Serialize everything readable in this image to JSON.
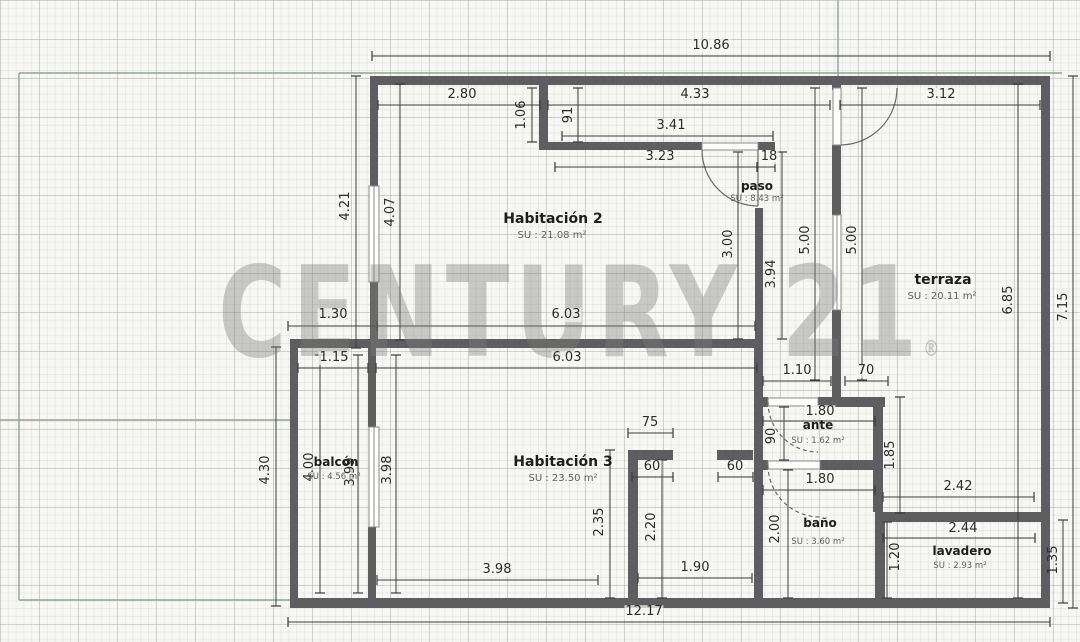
{
  "watermark": {
    "text": "CENTURY 21",
    "registered": "®"
  },
  "rooms": [
    {
      "name": "Habitación 2",
      "area": "SU : 21.08 m²",
      "nx": 553,
      "ny": 219,
      "ax": 552,
      "ay": 236,
      "fs": 14,
      "afs": 10
    },
    {
      "name": "paso",
      "area": "SU : 8.43 m²",
      "nx": 757,
      "ny": 186,
      "ax": 757,
      "ay": 199,
      "fs": 12,
      "afs": 8.5
    },
    {
      "name": "terraza",
      "area": "SU : 20.11 m²",
      "nx": 943,
      "ny": 280,
      "ax": 942,
      "ay": 297,
      "fs": 14,
      "afs": 10
    },
    {
      "name": "Habitación 3",
      "area": "SU : 23.50 m²",
      "nx": 563,
      "ny": 462,
      "ax": 563,
      "ay": 479,
      "fs": 14,
      "afs": 10
    },
    {
      "name": "balcón",
      "area": "SU : 4.56 m²",
      "nx": 336,
      "ny": 462,
      "ax": 334,
      "ay": 477,
      "fs": 12,
      "afs": 8.5
    },
    {
      "name": "ante",
      "area": "SU : 1.62 m²",
      "nx": 818,
      "ny": 425,
      "ax": 818,
      "ay": 441,
      "fs": 12,
      "afs": 8.5
    },
    {
      "name": "baño",
      "area": "SU : 3.60 m²",
      "nx": 820,
      "ny": 523,
      "ax": 818,
      "ay": 542,
      "fs": 12,
      "afs": 8.5
    },
    {
      "name": "lavadero",
      "area": "SU : 2.93 m²",
      "nx": 962,
      "ny": 551,
      "ax": 960,
      "ay": 566,
      "fs": 12,
      "afs": 8.5
    }
  ],
  "dims": [
    {
      "t": "10.86",
      "x": 711,
      "y": 46,
      "rot": 0,
      "line": [
        372,
        56,
        1050,
        56
      ]
    },
    {
      "t": "2.80",
      "x": 462,
      "y": 95,
      "rot": 0,
      "line": [
        378,
        105,
        540,
        105
      ]
    },
    {
      "t": "4.33",
      "x": 695,
      "y": 95,
      "rot": 0,
      "line": [
        548,
        105,
        830,
        105
      ]
    },
    {
      "t": "3.12",
      "x": 941,
      "y": 95,
      "rot": 0,
      "line": [
        840,
        105,
        1040,
        105
      ]
    },
    {
      "t": "3.41",
      "x": 671,
      "y": 126,
      "rot": 0,
      "line": [
        562,
        136,
        773,
        136
      ]
    },
    {
      "t": "3.23",
      "x": 660,
      "y": 157,
      "rot": 0,
      "line": [
        555,
        167,
        757,
        167
      ]
    },
    {
      "t": "18",
      "x": 769,
      "y": 157,
      "rot": 0,
      "line": [
        757,
        167,
        775,
        167
      ]
    },
    {
      "t": "1.30",
      "x": 333,
      "y": 315,
      "rot": 0,
      "line": [
        288,
        326,
        377,
        326
      ]
    },
    {
      "t": "6.03",
      "x": 566,
      "y": 315,
      "rot": 0,
      "line": [
        377,
        326,
        755,
        326
      ]
    },
    {
      "t": "1.15",
      "x": 334,
      "y": 358,
      "rot": 0,
      "line": [
        298,
        368,
        368,
        368
      ]
    },
    {
      "t": "6.03",
      "x": 567,
      "y": 358,
      "rot": 0,
      "line": [
        376,
        368,
        757,
        368
      ]
    },
    {
      "t": "1.10",
      "x": 797,
      "y": 371,
      "rot": 0,
      "line": [
        763,
        381,
        831,
        381
      ]
    },
    {
      "t": "70",
      "x": 866,
      "y": 371,
      "rot": 0,
      "line": [
        845,
        381,
        888,
        381
      ]
    },
    {
      "t": "1.80",
      "x": 820,
      "y": 412,
      "rot": 0,
      "line": [
        763,
        421,
        875,
        421
      ]
    },
    {
      "t": "1.80",
      "x": 820,
      "y": 480,
      "rot": 0,
      "line": [
        763,
        490,
        875,
        490
      ]
    },
    {
      "t": "2.42",
      "x": 958,
      "y": 487,
      "rot": 0,
      "line": [
        883,
        497,
        1034,
        497
      ]
    },
    {
      "t": "2.44",
      "x": 963,
      "y": 529,
      "rot": 0,
      "line": [
        883,
        538,
        1035,
        538
      ]
    },
    {
      "t": "75",
      "x": 650,
      "y": 423,
      "rot": 0,
      "line": [
        628,
        433,
        673,
        433
      ]
    },
    {
      "t": "60",
      "x": 652,
      "y": 467,
      "rot": 0,
      "line": [
        632,
        477,
        673,
        477
      ]
    },
    {
      "t": "60",
      "x": 735,
      "y": 467,
      "rot": 0,
      "line": [
        718,
        477,
        753,
        477
      ]
    },
    {
      "t": "1.90",
      "x": 695,
      "y": 568,
      "rot": 0,
      "line": [
        638,
        578,
        752,
        578
      ]
    },
    {
      "t": "3.98",
      "x": 497,
      "y": 570,
      "rot": 0,
      "line": [
        377,
        580,
        598,
        580
      ]
    },
    {
      "t": "12.17",
      "x": 644,
      "y": 612,
      "rot": 0,
      "line": [
        288,
        622,
        1050,
        622
      ]
    },
    {
      "t": "4.21",
      "x": 346,
      "y": 206,
      "rot": 1,
      "line": [
        356,
        76,
        356,
        348
      ]
    },
    {
      "t": "4.07",
      "x": 391,
      "y": 212,
      "rot": 1,
      "line": [
        400,
        84,
        400,
        340
      ]
    },
    {
      "t": "1.06",
      "x": 522,
      "y": 115,
      "rot": 1,
      "line": [
        532,
        88,
        532,
        142
      ]
    },
    {
      "t": "91",
      "x": 569,
      "y": 115,
      "rot": 1,
      "line": [
        578,
        88,
        578,
        142
      ]
    },
    {
      "t": "3.00",
      "x": 729,
      "y": 244,
      "rot": 1,
      "line": [
        738,
        152,
        738,
        339
      ]
    },
    {
      "t": "3.94",
      "x": 772,
      "y": 274,
      "rot": 1,
      "line": [
        782,
        152,
        782,
        339
      ]
    },
    {
      "t": "5.00",
      "x": 806,
      "y": 240,
      "rot": 1,
      "line": [
        815,
        88,
        815,
        380
      ]
    },
    {
      "t": "5.00",
      "x": 853,
      "y": 240,
      "rot": 1,
      "line": [
        862,
        88,
        862,
        380
      ]
    },
    {
      "t": "6.85",
      "x": 1009,
      "y": 300,
      "rot": 1,
      "line": [
        1018,
        84,
        1018,
        598
      ]
    },
    {
      "t": "7.15",
      "x": 1064,
      "y": 307,
      "rot": 1,
      "line": [
        1073,
        76,
        1073,
        608
      ]
    },
    {
      "t": "90",
      "x": 772,
      "y": 436,
      "rot": 1,
      "line": [
        784,
        407,
        784,
        460
      ]
    },
    {
      "t": "1.85",
      "x": 891,
      "y": 455,
      "rot": 1,
      "line": [
        900,
        397,
        900,
        513
      ]
    },
    {
      "t": "2.00",
      "x": 776,
      "y": 529,
      "rot": 1,
      "line": [
        788,
        470,
        788,
        598
      ]
    },
    {
      "t": "1.20",
      "x": 896,
      "y": 557,
      "rot": 1,
      "line": [
        887,
        522,
        887,
        598
      ]
    },
    {
      "t": "1.35",
      "x": 1054,
      "y": 560,
      "rot": 1,
      "line": [
        1063,
        520,
        1063,
        603
      ]
    },
    {
      "t": "4.30",
      "x": 266,
      "y": 470,
      "rot": 1,
      "line": [
        276,
        347,
        276,
        606
      ]
    },
    {
      "t": "4.00",
      "x": 310,
      "y": 467,
      "rot": 1,
      "line": [
        320,
        355,
        320,
        593
      ]
    },
    {
      "t": "3.99",
      "x": 351,
      "y": 472,
      "rot": 1,
      "line": [
        358,
        355,
        358,
        593
      ]
    },
    {
      "t": "3.98",
      "x": 388,
      "y": 470,
      "rot": 1,
      "line": [
        396,
        355,
        396,
        593
      ]
    },
    {
      "t": "2.35",
      "x": 600,
      "y": 522,
      "rot": 1,
      "line": [
        610,
        450,
        610,
        598
      ]
    },
    {
      "t": "2.20",
      "x": 652,
      "y": 527,
      "rot": 1,
      "line": [
        662,
        460,
        662,
        598
      ]
    }
  ],
  "plan": {
    "colors": {
      "wall": "#5e5e60",
      "boundary": "#93a294",
      "frame": "#8a8a8a",
      "dim": "#3c3c3c"
    },
    "boundary_lines": [
      [
        19,
        73,
        1062,
        73
      ],
      [
        19,
        73,
        19,
        600
      ],
      [
        0,
        420,
        290,
        420
      ],
      [
        19,
        600,
        290,
        600
      ],
      [
        838,
        0,
        838,
        76
      ]
    ],
    "walls": [
      [
        372,
        76,
        678,
        9
      ],
      [
        1041,
        76,
        9,
        532
      ],
      [
        370,
        76,
        8,
        110
      ],
      [
        370,
        282,
        8,
        66
      ],
      [
        539,
        84,
        9,
        66
      ],
      [
        539,
        142,
        163,
        8
      ],
      [
        758,
        142,
        17,
        8
      ],
      [
        755,
        208,
        8,
        139
      ],
      [
        290,
        339,
        473,
        9
      ],
      [
        290,
        339,
        8,
        269
      ],
      [
        368,
        347,
        8,
        80
      ],
      [
        368,
        527,
        8,
        79
      ],
      [
        290,
        598,
        760,
        10
      ],
      [
        832,
        84,
        9,
        6
      ],
      [
        832,
        145,
        9,
        70
      ],
      [
        832,
        310,
        9,
        87
      ],
      [
        762,
        397,
        6,
        10
      ],
      [
        818,
        397,
        67,
        10
      ],
      [
        873,
        397,
        10,
        115
      ],
      [
        763,
        460,
        5,
        10
      ],
      [
        820,
        460,
        55,
        10
      ],
      [
        754,
        347,
        9,
        251
      ],
      [
        628,
        450,
        45,
        10
      ],
      [
        628,
        450,
        10,
        148
      ],
      [
        717,
        450,
        36,
        10
      ],
      [
        875,
        512,
        170,
        10
      ],
      [
        875,
        512,
        10,
        86
      ]
    ],
    "openings": [
      {
        "r": [
          369,
          186,
          10,
          96
        ],
        "type": "window"
      },
      {
        "r": [
          369,
          427,
          10,
          100
        ],
        "type": "window"
      },
      {
        "r": [
          833,
          215,
          8,
          95
        ],
        "type": "window"
      },
      {
        "r": [
          833,
          88,
          8,
          57
        ],
        "type": "door"
      },
      {
        "r": [
          702,
          143,
          56,
          7
        ],
        "type": "door"
      },
      {
        "r": [
          768,
          398,
          50,
          8
        ],
        "type": "door"
      },
      {
        "r": [
          768,
          461,
          52,
          8
        ],
        "type": "door"
      }
    ],
    "door_arcs": [
      {
        "d": "M 702 150 A 56 56 0 0 0 758 206",
        "dashed": false
      },
      {
        "d": "M 758 150 L 758 206",
        "dashed": false
      },
      {
        "d": "M 841 145 A 57 57 0 0 0 897 88",
        "dashed": false
      },
      {
        "d": "M 768 402 A 50 50 0 0 0 818 452",
        "dashed": true
      },
      {
        "d": "M 768 465 A 52 52 0 0 0 820 517",
        "dashed": true
      }
    ]
  }
}
